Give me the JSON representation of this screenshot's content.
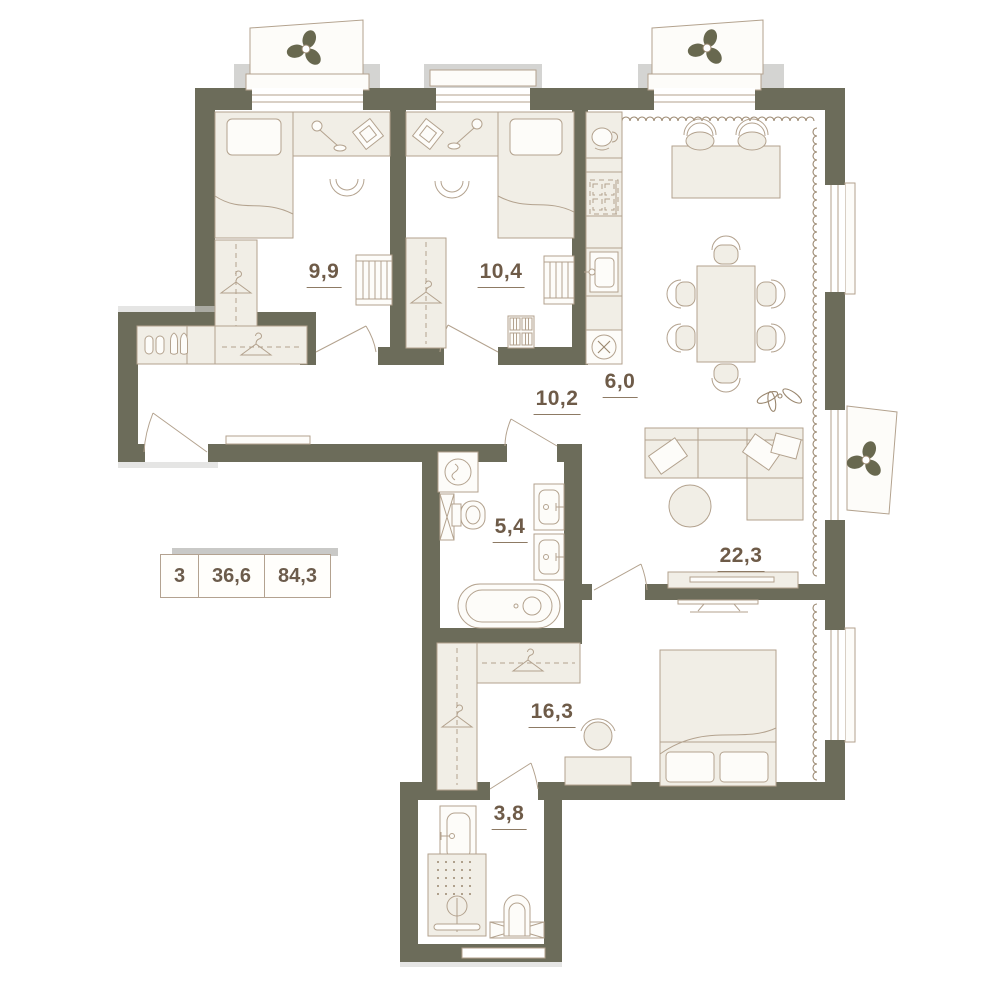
{
  "floor_plan": {
    "legend": {
      "rooms_count": "3",
      "living_area": "36,6",
      "total_area": "84,3"
    },
    "rooms": {
      "bedroom_1": {
        "area_label": "9,9"
      },
      "bedroom_2": {
        "area_label": "10,4"
      },
      "kitchen": {
        "area_label": "6,0"
      },
      "corridor": {
        "area_label": "10,2"
      },
      "bathroom": {
        "area_label": "5,4"
      },
      "living_room": {
        "area_label": "22,3"
      },
      "bedroom_3": {
        "area_label": "16,3"
      },
      "shower_room": {
        "area_label": "3,8"
      }
    },
    "colors": {
      "wall": "#6c6c5a",
      "furniture_fill": "#f1eee6",
      "outline": "#b3a28e",
      "label_text": "#6e5b48",
      "slab": "#d4d4d2",
      "background": "#ffffff"
    },
    "icons": [
      "fan-icon",
      "hanger-icon",
      "shoes-icon",
      "coffee-cup-icon",
      "stove-icon",
      "kitchen-sink-icon",
      "extractor-fan-icon",
      "bar-stool-icon",
      "dining-chair-icon",
      "desk-chair-icon",
      "desk-lamp-icon",
      "picture-frame-icon",
      "crib-icon",
      "bookshelf-icon",
      "plant-icon",
      "sofa-icon",
      "coffee-table-icon",
      "tv-icon",
      "washing-machine-icon",
      "vent-shaft-icon",
      "toilet-icon",
      "washbasin-icon",
      "bathtub-icon",
      "shower-icon",
      "doormat-icon",
      "bed-icon",
      "wardrobe-icon",
      "door-arc",
      "window-glazing"
    ]
  }
}
